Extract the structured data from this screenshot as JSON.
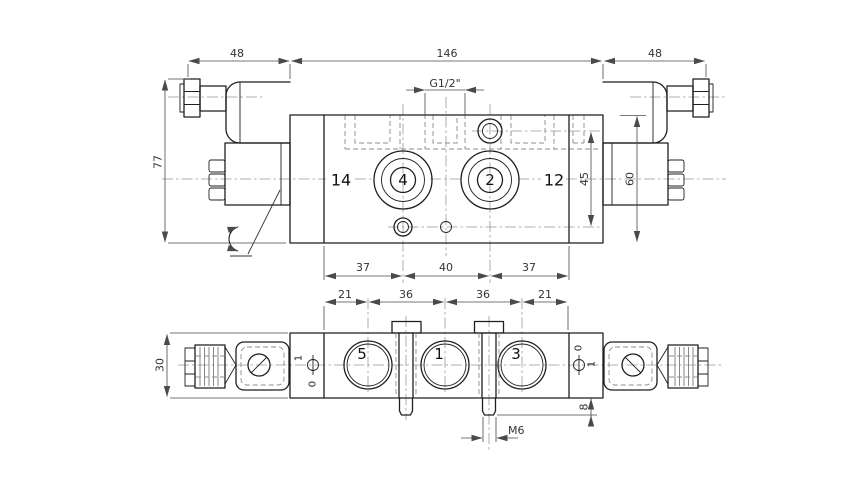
{
  "colors": {
    "ink": "#1f1f1f",
    "background": "#ffffff",
    "dimension_lines": "#4a4a4a",
    "hidden_lines": "#8c8c8c",
    "centerlines": "#999999"
  },
  "top_view": {
    "dim_left_solenoid_width": "48",
    "dim_body_width": "146",
    "dim_right_solenoid_width": "48",
    "dim_total_height": "77",
    "thread_label": "G1/2\"",
    "pilot_label_left": "14",
    "port_4": "4",
    "port_2": "2",
    "pilot_label_right": "12",
    "dim_pilot_offset": "45",
    "dim_body_height": "60",
    "dim_spacing_left": "37",
    "dim_spacing_center": "40",
    "dim_spacing_right": "37"
  },
  "bottom_view": {
    "dim_end_left": "21",
    "dim_pitch_left": "36",
    "dim_pitch_right": "36",
    "dim_end_right": "21",
    "dim_body_height": "30",
    "port_5": "5",
    "port_1": "1",
    "port_3": "3",
    "override_left_pos1": "1",
    "override_left_pos0": "0",
    "override_right_pos0": "0",
    "override_right_pos1": "1",
    "dim_screw_protrusion": "8",
    "screw_thread_label": "M6"
  }
}
